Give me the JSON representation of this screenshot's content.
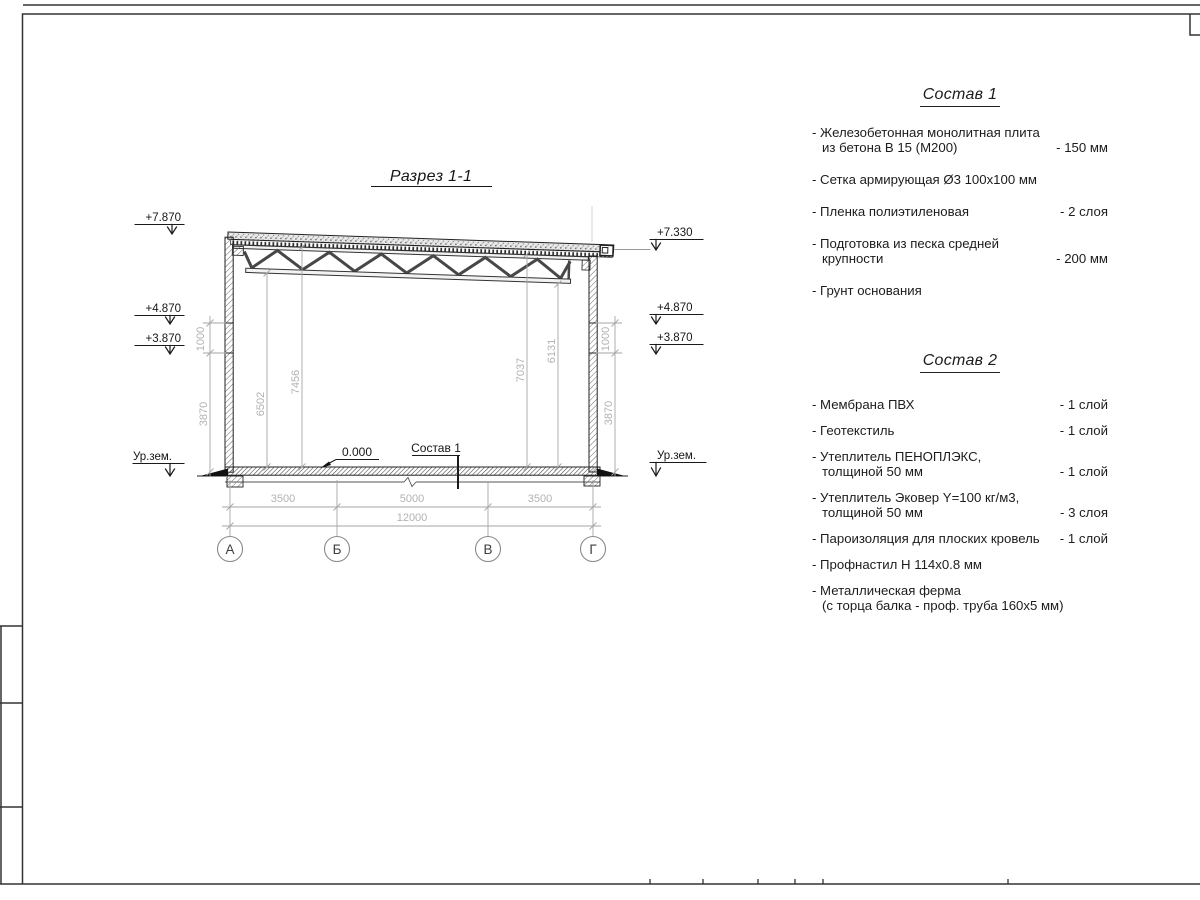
{
  "page": {
    "background": "#ffffff",
    "line_color": "#333333",
    "dim_color": "#b2b2b2"
  },
  "drawing": {
    "title": "Разрез 1-1",
    "marks_left": [
      "+7.870",
      "+4.870",
      "+3.870",
      "Ур.зем."
    ],
    "marks_right": [
      "+7.330",
      "+4.870",
      "+3.870",
      "Ур.зем."
    ],
    "zero_mark": "0.000",
    "floor_label": "Состав 1",
    "dims": {
      "left_wall": [
        "1000",
        "3870"
      ],
      "right_wall": [
        "1000",
        "3870"
      ],
      "interior": [
        "6502",
        "7456",
        "7037",
        "6131"
      ],
      "spans": [
        "3500",
        "5000",
        "3500"
      ],
      "total": "12000"
    },
    "axes": [
      "А",
      "Б",
      "В",
      "Г"
    ]
  },
  "sostav1": {
    "title": "Состав 1",
    "items": [
      {
        "lines": [
          "- Железобетонная  монолитная плита",
          "из бетона В 15 (М200)"
        ],
        "qty": "- 150 мм"
      },
      {
        "lines": [
          "- Сетка армирующая Ø3 100х100 мм"
        ],
        "qty": ""
      },
      {
        "lines": [
          "- Пленка полиэтиленовая"
        ],
        "qty": "-  2 слоя"
      },
      {
        "lines": [
          "- Подготовка из песка средней",
          "крупности"
        ],
        "qty": "- 200 мм"
      },
      {
        "lines": [
          "- Грунт основания"
        ],
        "qty": ""
      }
    ]
  },
  "sostav2": {
    "title": "Состав 2",
    "items": [
      {
        "lines": [
          "- Мембрана ПВХ"
        ],
        "qty": "- 1 слой"
      },
      {
        "lines": [
          "- Геотекстиль"
        ],
        "qty": "- 1 слой"
      },
      {
        "lines": [
          "- Утеплитель ПЕНОПЛЭКС,",
          "толщиной 50 мм"
        ],
        "qty": "- 1 слой"
      },
      {
        "lines": [
          "- Утеплитель Эковер Y=100 кг/м3,",
          "толщиной 50 мм"
        ],
        "qty": "- 3 слоя"
      },
      {
        "lines": [
          "- Пароизоляция для плоских кровель"
        ],
        "qty": "- 1 слой"
      },
      {
        "lines": [
          "- Профнастил Н 114х0.8 мм"
        ],
        "qty": ""
      },
      {
        "lines": [
          "- Металлическая ферма",
          "(с торца балка - проф. труба 160х5 мм)"
        ],
        "qty": ""
      }
    ]
  }
}
